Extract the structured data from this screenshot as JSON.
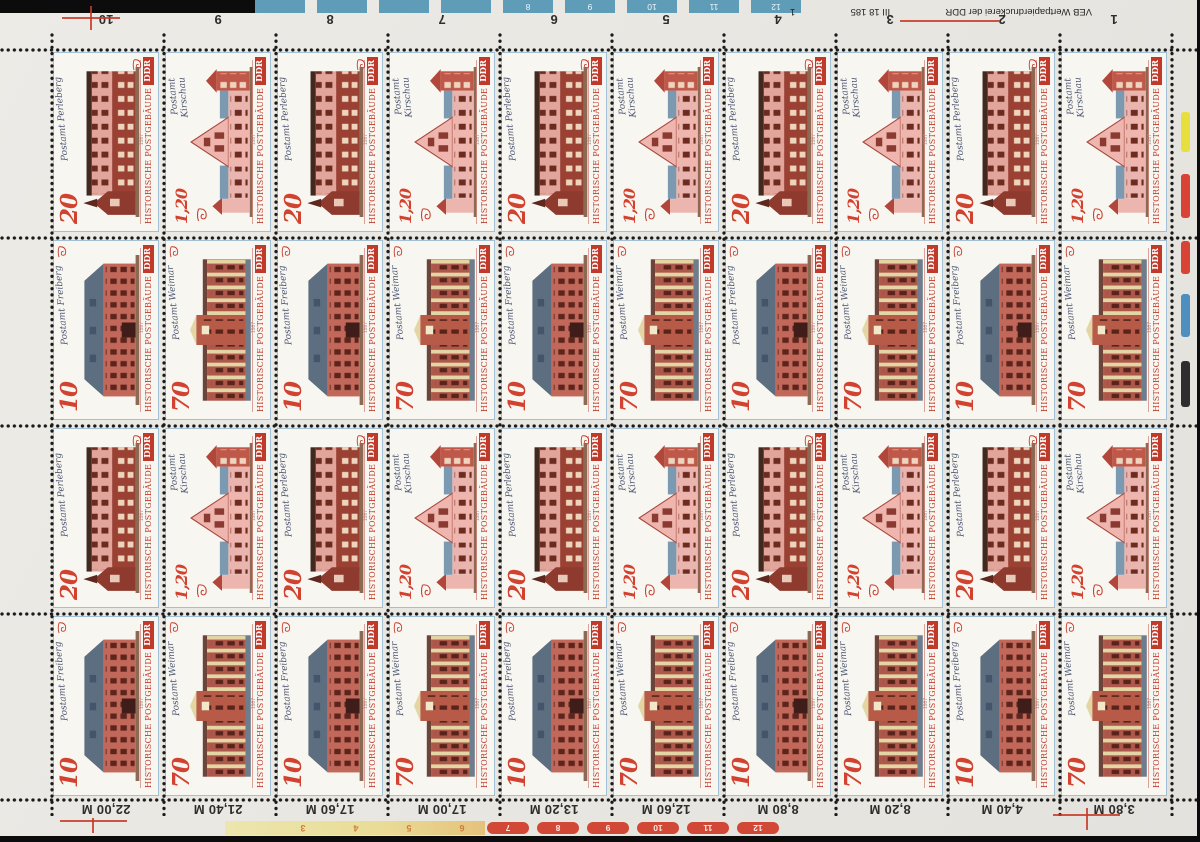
{
  "photo": {
    "background": "#0a0a0a",
    "paper": "#e8e6e1"
  },
  "sheet": {
    "caption": "HISTORISCHE POSTGEBÄUDE",
    "country": "DDR",
    "year": "1987",
    "accent_red": "#bf3a2b",
    "stamps": {
      "s20": {
        "value": "20",
        "name": "Postamt Perleberg"
      },
      "s120": {
        "value": "1,20",
        "name_line1": "Postamt",
        "name_line2": "Kirschau"
      },
      "s10": {
        "value": "10",
        "name": "Postamt Freiberg"
      },
      "s70": {
        "value": "70",
        "name": "Postamt Weimar"
      }
    },
    "top_margin": {
      "column_numbers": [
        "10",
        "9",
        "8",
        "7",
        "6",
        "5",
        "4",
        "3",
        "2",
        "1"
      ],
      "imprint": "VEB Wertpapierdruckerei der DDR",
      "form_number": "III 18 185",
      "sheet_counter": "1"
    },
    "bottom_margin": {
      "cumulative_values": [
        "22,00 M",
        "21,40 M",
        "17,60 M",
        "17,00 M",
        "13,20 M",
        "12,60 M",
        "8,80 M",
        "8,20 M",
        "4,40 M",
        "3,80 M"
      ]
    },
    "control_strips": {
      "top_blue": {
        "color": "#5e9cb8",
        "numbers": [
          "8",
          "9",
          "10",
          "11",
          "12"
        ]
      },
      "bottom_yellow": {
        "color": "#e9dc96",
        "numbers": [
          "3",
          "4",
          "5",
          "6"
        ]
      },
      "bottom_red": {
        "color": "#d14936",
        "numbers": [
          "7",
          "8",
          "9",
          "10",
          "11",
          "12"
        ]
      },
      "right_edge_bars": [
        "#e6df3e",
        "#d84335",
        "#d84335",
        "#4f8fc0",
        "#2e2e2e"
      ]
    }
  }
}
